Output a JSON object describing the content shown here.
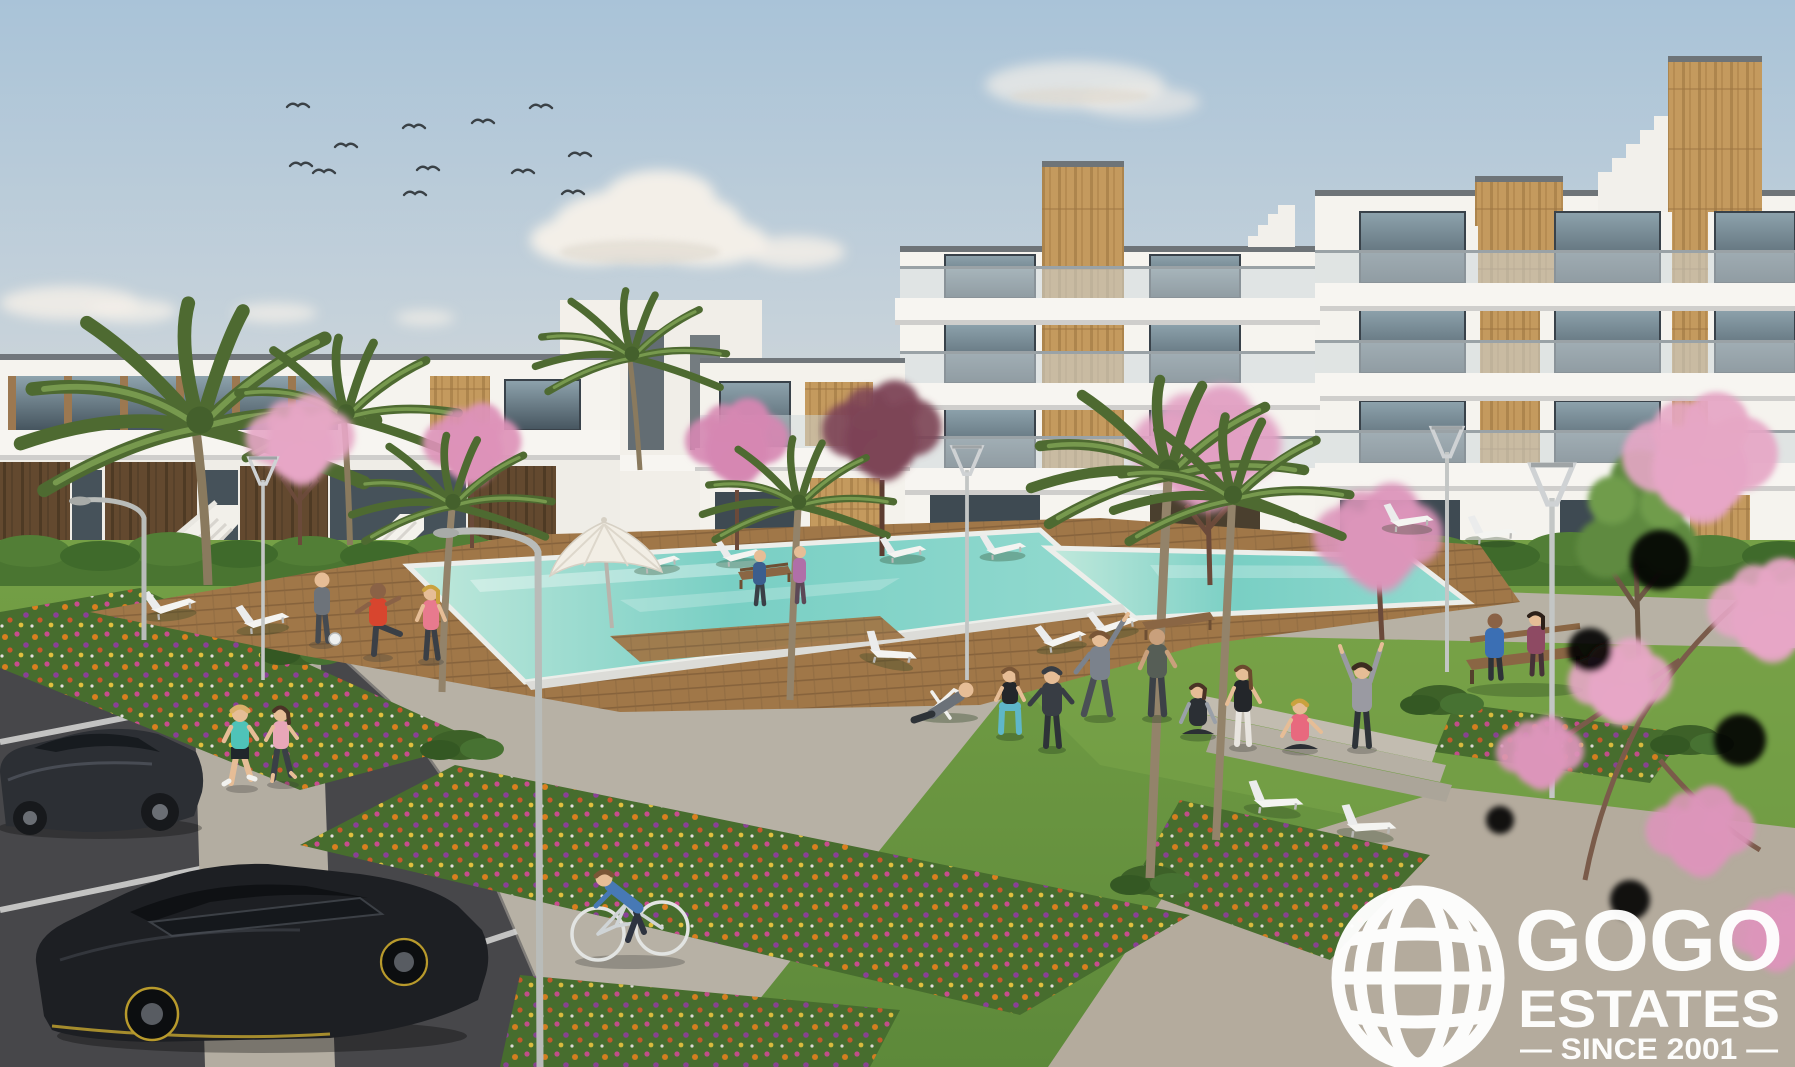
{
  "image": {
    "type": "architectural-render",
    "subject": "new-build residential apartment complex with communal pool garden, seen from the visitor parking",
    "style": "photorealistic CGI marketing visual"
  },
  "brand": {
    "name": "GOGO ESTATES",
    "logo_line1": "GOGO",
    "logo_line2": "ESTATES",
    "logo_line3": "— SINCE 2001 —",
    "logo_icon": "globe-icon",
    "logo_color": "#ffffff"
  },
  "palette": {
    "sky_top": "#a9c3d8",
    "sky_horizon": "#e6ddd0",
    "cloud": "#f3efe8",
    "building_white": "#f5f3ee",
    "slab_shadow": "#cfcecc",
    "parapet_cap": "#6e7478",
    "glass_dark": "#46555f",
    "glass_light": "#8ea3ad",
    "balustrade_glass": "#cdd7da",
    "wood_tan": "#c49a5e",
    "wood_dark": "#63492f",
    "hedge_green": "#4a7531",
    "lawn_green": "#6f9a42",
    "flower_bed": "#476d2e",
    "flower_orange": "#e2801f",
    "flower_magenta": "#cf4b93",
    "flower_purple": "#8e3e9b",
    "blossom_pink": "#e6a6c5",
    "palm_green": "#4e6a31",
    "pool_water": "#79cfc4",
    "deck_wood": "#a07748",
    "path_grey": "#b7b1a5",
    "asphalt": "#47474a",
    "car_black": "#1d1f23",
    "car_accent_yellow": "#c8a830"
  },
  "scene": {
    "sky": {
      "birds": 12,
      "clouds": 6
    },
    "buildings": {
      "right_wing_floors": 4,
      "left_wing_floors": 2,
      "materials": [
        "white render",
        "timber cladding",
        "glass balustrades",
        "rooftop stair towers"
      ]
    },
    "amenities": [
      "swimming pool",
      "timber pool deck",
      "sun loungers",
      "white parasol",
      "benches",
      "lawn",
      "flower beds",
      "palm trees",
      "cherry blossom trees",
      "street lamps",
      "park lamps",
      "parking bays",
      "paved walkways",
      "steps"
    ],
    "people": [
      "two joggers",
      "cyclist",
      "man stretching by pool",
      "woman walking by pool",
      "person with football",
      "man on deck chair",
      "squatting woman",
      "person in hoodie",
      "man stretching arms up",
      "standing man",
      "woman doing yoga",
      "couple on bench",
      "woman standing by steps",
      "woman sitting by steps",
      "person cheering by steps",
      "two walkers on upper path"
    ],
    "vehicles": [
      "dark grey saloon car",
      "black hatchback car"
    ]
  }
}
